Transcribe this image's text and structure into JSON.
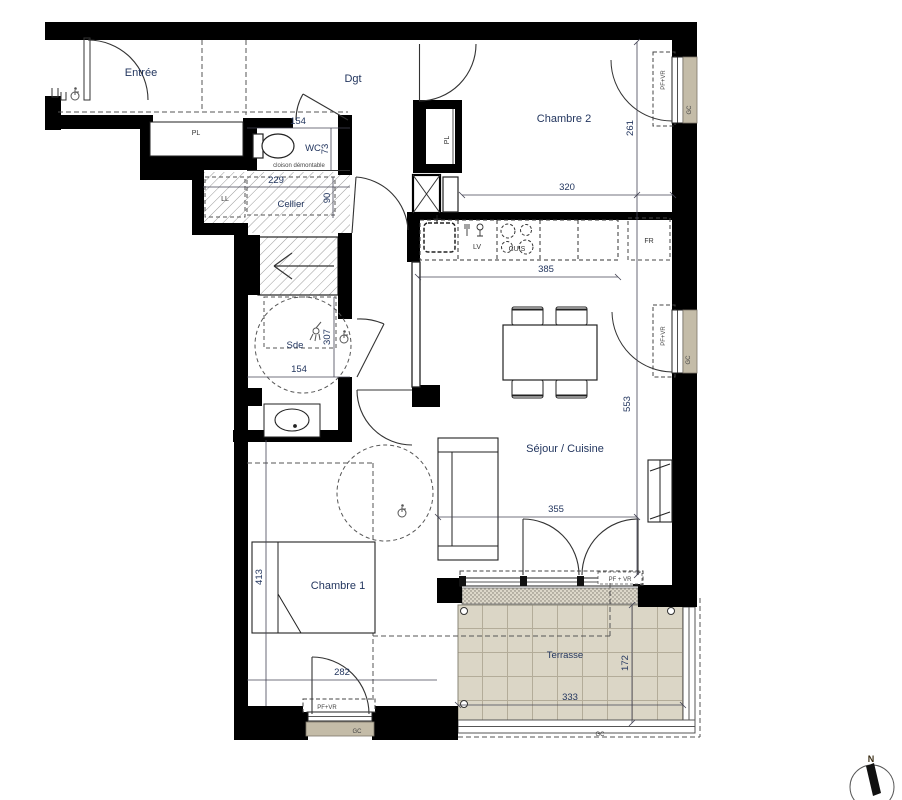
{
  "rooms": {
    "entree": "Entrée",
    "dgt": "Dgt",
    "wc": "WC",
    "cellier": "Cellier",
    "sde": "Sde",
    "chambre2": "Chambre 2",
    "sejour": "Séjour / Cuisine",
    "chambre1": "Chambre 1",
    "terrasse": "Terrasse"
  },
  "fixtures": {
    "pl_entree": "PL",
    "pl_chambre2": "PL",
    "ll": "LL",
    "lv": "LV",
    "cuis": "CUIS",
    "fr": "FR"
  },
  "dims": {
    "wc_w": "154",
    "wc_h": "73",
    "cellier_w": "229",
    "cellier_h": "90",
    "sde_w": "154",
    "sde_h": "307",
    "chambre2_w": "320",
    "chambre2_h": "261",
    "cuisine_w": "385",
    "sejour_h": "553",
    "sejour_w": "355",
    "chambre1_h": "413",
    "chambre1_w": "282",
    "terrasse_w": "333",
    "terrasse_h": "172"
  },
  "ann": {
    "cloison": "cloison démontable",
    "pf_vr": "PF+VR",
    "pf_vr_spaced": "PF + VR",
    "gc": "GC",
    "north": "N"
  },
  "colors": {
    "wall": "#000000",
    "label": "#23365f",
    "beige": "#c4bca8",
    "tile": "#dbd6c6"
  }
}
